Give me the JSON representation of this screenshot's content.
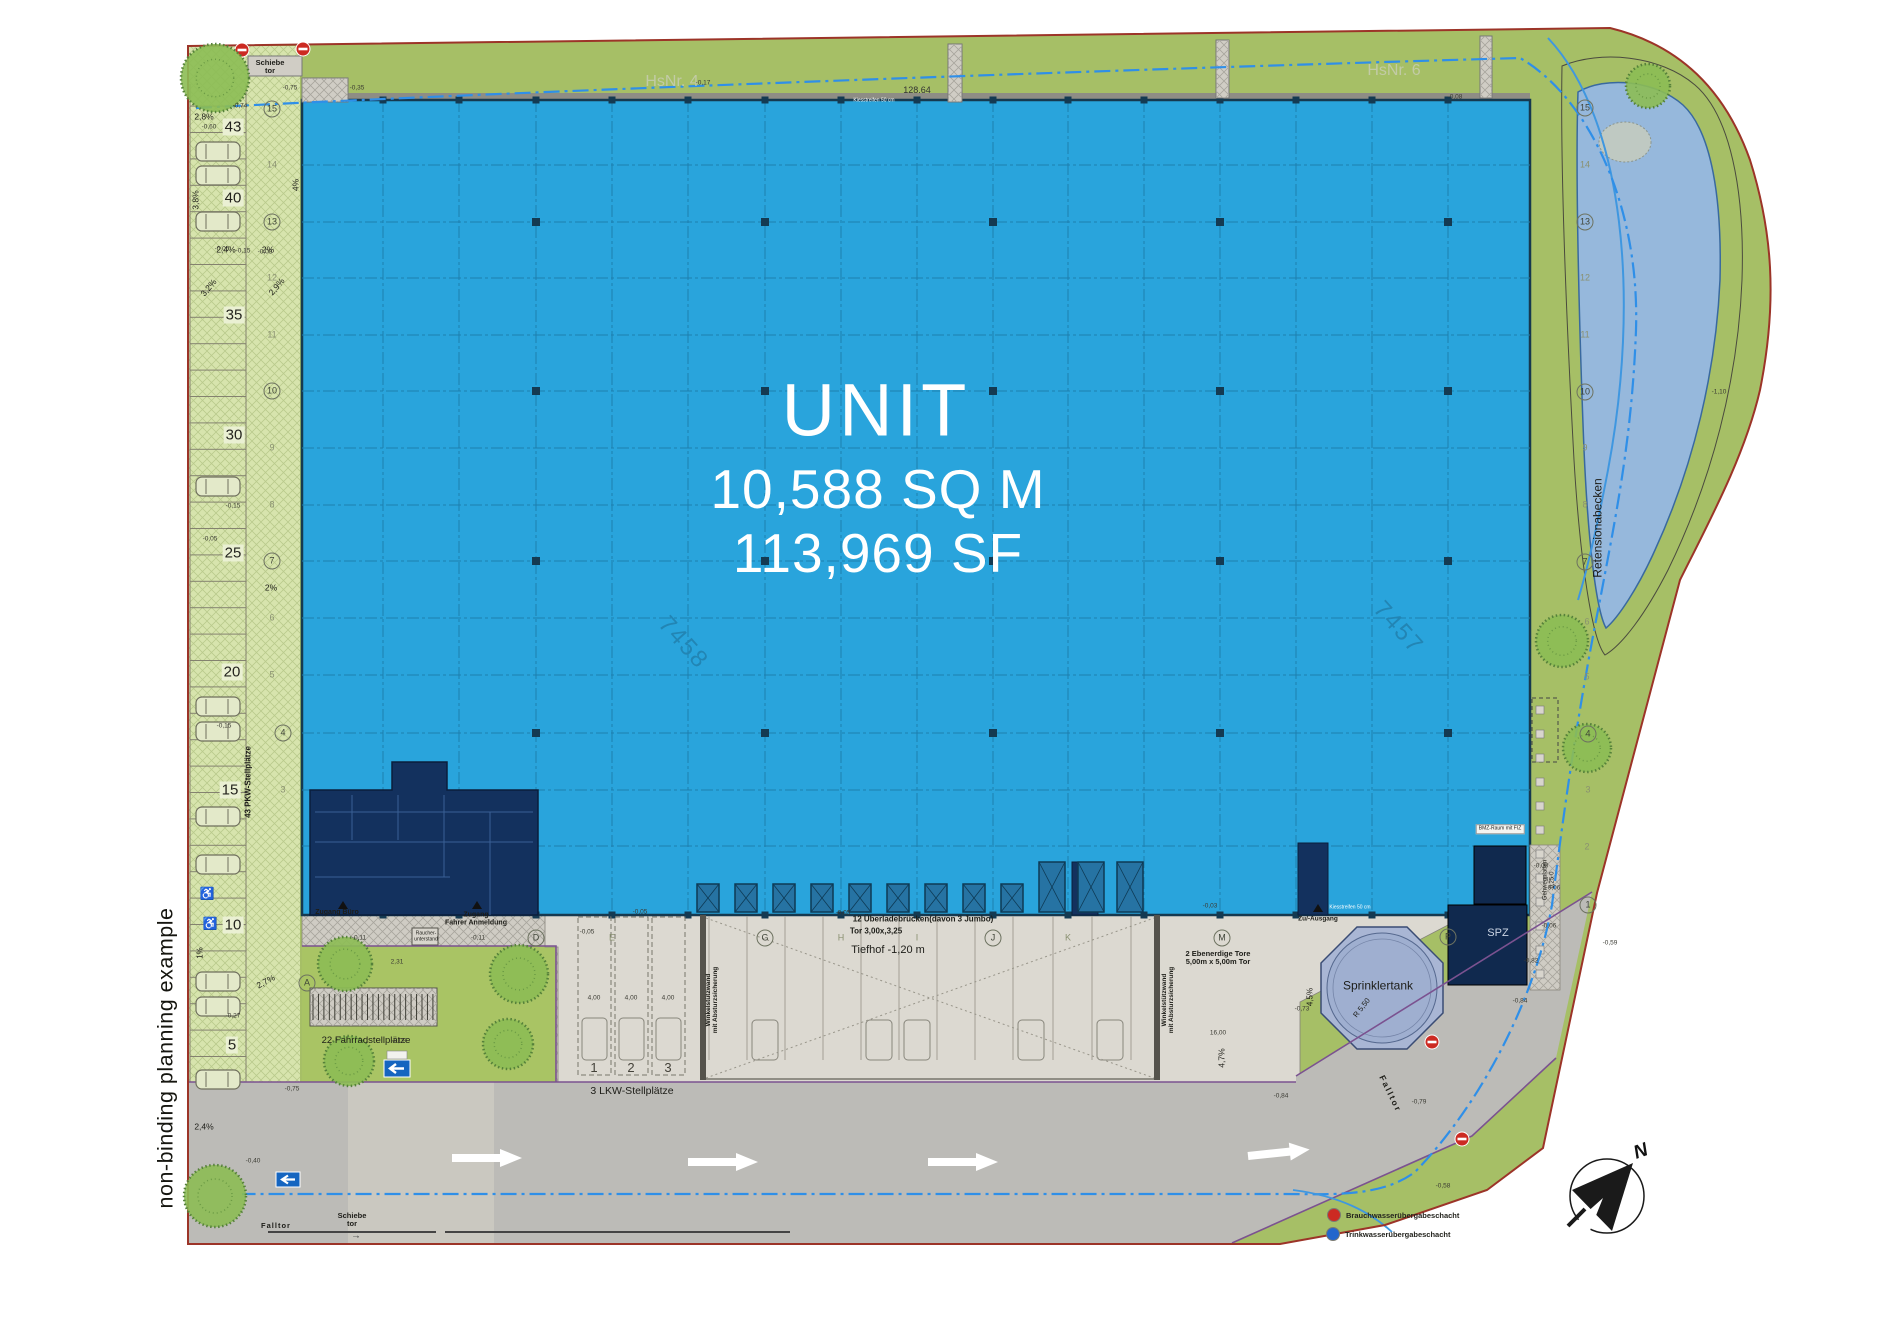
{
  "plan": {
    "unit_label": "UNIT",
    "area_sqm": "10,588 SQ M",
    "area_sf": "113,969 SF"
  },
  "note": "non-binding planning example",
  "compass": {
    "north_label": "N"
  },
  "legend": {
    "items": [
      {
        "label": "Brauchwasserübergabeschacht",
        "color": "#cc2a22"
      },
      {
        "label": "Trinkwasserübergabeschacht",
        "color": "#2266cc"
      }
    ]
  },
  "colors": {
    "hall_blue": "#29a4dc",
    "dark_navy": "#13315e",
    "dock_blue": "#2673a3",
    "parking_green": "#d7e4ad",
    "landscape_green": "#a6bf66",
    "lawn_green": "#a9c464",
    "basin_blue": "#96b8dc",
    "sprinkler_blue": "#a9b6d4",
    "road_gray": "#bcbbb7",
    "apron_gray": "#dcd9d1",
    "boundary_red": "#9c3428",
    "utility_blue_dash": "#2f8fe8",
    "edge_purple": "#7b5290"
  },
  "labels": [
    {
      "n": "hsnr-4-label",
      "t": "HsNr. 4",
      "x": 672,
      "y": 82,
      "s": 16,
      "c": "#c2cba6"
    },
    {
      "n": "hsnr-6-label",
      "t": "HsNr. 6",
      "x": 1394,
      "y": 71,
      "s": 16,
      "c": "#c2cba6"
    },
    {
      "n": "schiebetor-top-label",
      "t": "Schiebe\ntor",
      "x": 270,
      "y": 67,
      "s": 7.5,
      "w": 700
    },
    {
      "n": "schiebetor-bottom-label",
      "t": "Schiebe\ntor",
      "x": 352,
      "y": 1220,
      "s": 7.5,
      "w": 700
    },
    {
      "n": "schiebetor-arrow",
      "t": "→",
      "x": 356,
      "y": 1236,
      "s": 10,
      "c": "#444"
    },
    {
      "n": "falltor-sw-label",
      "t": "Falltor",
      "x": 276,
      "y": 1226,
      "s": 7.5,
      "w": 700,
      "ls": 1
    },
    {
      "n": "falltor-east-label",
      "t": "Falltor",
      "x": 1390,
      "y": 1094,
      "r": 64,
      "s": 8.5,
      "w": 700,
      "ls": 2
    },
    {
      "n": "zugang-buero-label",
      "t": "Zugang Büro",
      "x": 337,
      "y": 913,
      "s": 7,
      "w": 700
    },
    {
      "n": "zugang-fahrer-label",
      "t": "Zugang\nFahrer Anmeldung",
      "x": 476,
      "y": 919,
      "s": 7,
      "w": 700
    },
    {
      "n": "raucherunterstand-label",
      "t": "Raucher-\nunterstand",
      "x": 426,
      "y": 937,
      "s": 5
    },
    {
      "n": "fahrradstellplaetze-label",
      "t": "22 Fahrradstellplätze",
      "x": 366,
      "y": 1041,
      "s": 9.5
    },
    {
      "n": "lkw-stellplaetze-label",
      "t": "3 LKW-Stellplätze",
      "x": 632,
      "y": 1092,
      "s": 10.5
    },
    {
      "n": "lkw-stall-1",
      "t": "1",
      "x": 594,
      "y": 1068,
      "s": 13,
      "c": "#44423a"
    },
    {
      "n": "lkw-stall-2",
      "t": "2",
      "x": 631,
      "y": 1068,
      "s": 13,
      "c": "#44423a"
    },
    {
      "n": "lkw-stall-3",
      "t": "3",
      "x": 668,
      "y": 1068,
      "s": 13,
      "c": "#44423a"
    },
    {
      "n": "ueberladebruecken-label",
      "t": "12 Überladebrücken(davon 3 Jumbo)",
      "x": 923,
      "y": 920,
      "s": 8,
      "w": 700
    },
    {
      "n": "tor-label",
      "t": "Tor 3,00x,3,25",
      "x": 876,
      "y": 932,
      "s": 8,
      "w": 700
    },
    {
      "n": "tiefhof-label",
      "t": "Tiefhof -1,20 m",
      "x": 888,
      "y": 950,
      "s": 11
    },
    {
      "n": "ebenerdige-tore-label",
      "t": "2 Ebenerdige Tore\n5,00m x 5,00m Tor",
      "x": 1218,
      "y": 958,
      "s": 7.5,
      "w": 700
    },
    {
      "n": "winkelstuetzwand-west-label",
      "t": "Winkelstützwand\nmit Absturzsicherung",
      "x": 712,
      "y": 1000,
      "r": -90,
      "s": 6.5,
      "w": 700
    },
    {
      "n": "winkelstuetzwand-ost-label",
      "t": "Winkelstützwand\nmit Absturzsicherung",
      "x": 1168,
      "y": 1000,
      "r": -90,
      "s": 6.5,
      "w": 700
    },
    {
      "n": "pkw-stellplaetze-label",
      "t": "43 PKW-Stellplätze",
      "x": 249,
      "y": 782,
      "r": -90,
      "s": 8,
      "w": 700
    },
    {
      "n": "gehwegplatten-label",
      "t": "Gehwegplatten\n0,25·0",
      "x": 1549,
      "y": 880,
      "r": -90,
      "s": 6
    },
    {
      "n": "retensionabecken-label",
      "t": "Retensionabecken",
      "x": 1598,
      "y": 528,
      "r": -90,
      "s": 12
    },
    {
      "n": "sprinklertank-label",
      "t": "Sprinklertank",
      "x": 1378,
      "y": 986,
      "s": 12
    },
    {
      "n": "radius-550-label",
      "t": "R 5,50",
      "x": 1362,
      "y": 1008,
      "r": -52,
      "s": 7.5
    },
    {
      "n": "spz-label",
      "t": "SPZ",
      "x": 1498,
      "y": 933,
      "s": 11,
      "c": "#ccd5e4"
    },
    {
      "n": "bmz-raum-label",
      "t": "BMZ-Raum mit FIZ",
      "x": 1500,
      "y": 829,
      "s": 5,
      "bg": "#f4f4f0",
      "c": "#222"
    },
    {
      "n": "zu-ausgang-label",
      "t": "Zu/-Ausgang",
      "x": 1318,
      "y": 919,
      "s": 6.5,
      "w": 700
    },
    {
      "n": "parcel-7458",
      "t": "7458",
      "x": 683,
      "y": 643,
      "r": 48,
      "s": 24,
      "c": "#2285b4",
      "ls": 2
    },
    {
      "n": "parcel-7457",
      "t": "7457",
      "x": 1398,
      "y": 628,
      "r": 48,
      "s": 24,
      "c": "#2285b4",
      "ls": 2
    },
    {
      "n": "dim-128-64",
      "t": "128.64",
      "x": 917,
      "y": 91,
      "s": 9,
      "c": "#333"
    },
    {
      "n": "kiesstreifen-top-label",
      "t": "Kiesstreifen 50 cm",
      "x": 874,
      "y": 101,
      "s": 5,
      "c": "#fff"
    },
    {
      "n": "kiesstreifen-sued-label",
      "t": "Kiesstreifen 50 cm",
      "x": 1350,
      "y": 908,
      "s": 5,
      "c": "#fff"
    },
    {
      "n": "slope-label",
      "t": "2,8%",
      "x": 204,
      "y": 117,
      "s": 8.5
    },
    {
      "n": "slope-label",
      "t": "3,8%",
      "x": 196,
      "y": 200,
      "r": -90,
      "s": 8.5
    },
    {
      "n": "slope-label",
      "t": "2,4%",
      "x": 226,
      "y": 250,
      "s": 8.5
    },
    {
      "n": "slope-label",
      "t": "2%",
      "x": 268,
      "y": 250,
      "s": 8.5
    },
    {
      "n": "slope-label",
      "t": "4%",
      "x": 296,
      "y": 185,
      "r": -90,
      "s": 8.5
    },
    {
      "n": "slope-label",
      "t": "3,2%",
      "x": 209,
      "y": 288,
      "r": -50,
      "s": 8.5
    },
    {
      "n": "slope-label",
      "t": "2,9%",
      "x": 277,
      "y": 287,
      "r": -50,
      "s": 8.5
    },
    {
      "n": "slope-label",
      "t": "2%",
      "x": 271,
      "y": 588,
      "s": 8.5
    },
    {
      "n": "slope-label",
      "t": "2,7%",
      "x": 266,
      "y": 982,
      "r": -28,
      "s": 8.5
    },
    {
      "n": "slope-label",
      "t": "1%",
      "x": 201,
      "y": 953,
      "r": -90,
      "s": 8
    },
    {
      "n": "slope-label",
      "t": "2,4%",
      "x": 204,
      "y": 1127,
      "s": 8.5
    },
    {
      "n": "slope-label",
      "t": "4,5%",
      "x": 1311,
      "y": 997,
      "r": -90,
      "s": 8
    },
    {
      "n": "slope-label",
      "t": "4,7%",
      "x": 1222,
      "y": 1058,
      "r": -90,
      "s": 8.5
    },
    {
      "n": "accessible-parking-icon",
      "t": "♿",
      "x": 207,
      "y": 894,
      "s": 12,
      "c": "#555"
    },
    {
      "n": "accessible-parking-icon",
      "t": "♿",
      "x": 210,
      "y": 924,
      "s": 12,
      "c": "#555"
    }
  ],
  "stall_numbers": [
    {
      "v": "43",
      "x": 233,
      "y": 127
    },
    {
      "v": "40",
      "x": 233,
      "y": 198
    },
    {
      "v": "35",
      "x": 234,
      "y": 315
    },
    {
      "v": "30",
      "x": 234,
      "y": 435
    },
    {
      "v": "25",
      "x": 233,
      "y": 553
    },
    {
      "v": "20",
      "x": 232,
      "y": 672
    },
    {
      "v": "15",
      "x": 230,
      "y": 790
    },
    {
      "v": "10",
      "x": 233,
      "y": 925
    },
    {
      "v": "5",
      "x": 232,
      "y": 1045
    }
  ],
  "grid": {
    "cols": [
      {
        "l": "A",
        "x": 307,
        "y": 983,
        "c": true
      },
      {
        "l": "D",
        "x": 536,
        "y": 938,
        "c": true
      },
      {
        "l": "E",
        "x": 612,
        "y": 938,
        "c": false
      },
      {
        "l": "G",
        "x": 765,
        "y": 938,
        "c": true
      },
      {
        "l": "H",
        "x": 841,
        "y": 938,
        "c": false
      },
      {
        "l": "I",
        "x": 917,
        "y": 938,
        "c": false
      },
      {
        "l": "J",
        "x": 993,
        "y": 938,
        "c": true
      },
      {
        "l": "K",
        "x": 1068,
        "y": 938,
        "c": false
      },
      {
        "l": "M",
        "x": 1222,
        "y": 938,
        "c": true
      },
      {
        "l": "P",
        "x": 1448,
        "y": 937,
        "c": true
      }
    ],
    "rows_left": [
      {
        "l": "15",
        "x": 272,
        "y": 109,
        "c": true
      },
      {
        "l": "14",
        "x": 272,
        "y": 165,
        "c": false
      },
      {
        "l": "13",
        "x": 272,
        "y": 222,
        "c": true
      },
      {
        "l": "12",
        "x": 272,
        "y": 278,
        "c": false
      },
      {
        "l": "11",
        "x": 272,
        "y": 335,
        "c": false
      },
      {
        "l": "10",
        "x": 272,
        "y": 391,
        "c": true
      },
      {
        "l": "9",
        "x": 272,
        "y": 448,
        "c": false
      },
      {
        "l": "8",
        "x": 272,
        "y": 505,
        "c": false
      },
      {
        "l": "7",
        "x": 272,
        "y": 561,
        "c": true
      },
      {
        "l": "6",
        "x": 272,
        "y": 618,
        "c": false
      },
      {
        "l": "5",
        "x": 272,
        "y": 675,
        "c": false
      },
      {
        "l": "4",
        "x": 283,
        "y": 733,
        "c": true
      },
      {
        "l": "3",
        "x": 283,
        "y": 790,
        "c": false
      }
    ],
    "rows_right": [
      {
        "l": "15",
        "x": 1585,
        "y": 108,
        "c": true
      },
      {
        "l": "14",
        "x": 1585,
        "y": 165,
        "c": false
      },
      {
        "l": "13",
        "x": 1585,
        "y": 222,
        "c": true
      },
      {
        "l": "12",
        "x": 1585,
        "y": 278,
        "c": false
      },
      {
        "l": "11",
        "x": 1585,
        "y": 335,
        "c": false
      },
      {
        "l": "10",
        "x": 1585,
        "y": 392,
        "c": true
      },
      {
        "l": "9",
        "x": 1585,
        "y": 448,
        "c": false
      },
      {
        "l": "8",
        "x": 1585,
        "y": 505,
        "c": false
      },
      {
        "l": "7",
        "x": 1585,
        "y": 562,
        "c": true
      },
      {
        "l": "6",
        "x": 1587,
        "y": 622,
        "c": false
      },
      {
        "l": "5",
        "x": 1587,
        "y": 677,
        "c": false
      },
      {
        "l": "4",
        "x": 1588,
        "y": 734,
        "c": true
      },
      {
        "l": "3",
        "x": 1588,
        "y": 790,
        "c": false
      },
      {
        "l": "2",
        "x": 1587,
        "y": 847,
        "c": false
      },
      {
        "l": "1",
        "x": 1588,
        "y": 905,
        "c": true
      }
    ]
  },
  "spot_values": [
    {
      "x": 290,
      "y": 88,
      "t": "-0,75"
    },
    {
      "x": 357,
      "y": 88,
      "t": "-0,35"
    },
    {
      "x": 703,
      "y": 83,
      "t": "-0,17"
    },
    {
      "x": 1455,
      "y": 97,
      "t": "-0,08"
    },
    {
      "x": 240,
      "y": 106,
      "t": "-0,74"
    },
    {
      "x": 209,
      "y": 127,
      "t": "-0,60"
    },
    {
      "x": 222,
      "y": 249,
      "t": "-0,05"
    },
    {
      "x": 243,
      "y": 251,
      "t": "-0,15"
    },
    {
      "x": 265,
      "y": 252,
      "t": "-0,03"
    },
    {
      "x": 233,
      "y": 506,
      "t": "-0,15"
    },
    {
      "x": 210,
      "y": 539,
      "t": "-0,05"
    },
    {
      "x": 224,
      "y": 726,
      "t": "-0,15"
    },
    {
      "x": 233,
      "y": 1016,
      "t": "-0,27"
    },
    {
      "x": 253,
      "y": 1161,
      "t": "-0,40"
    },
    {
      "x": 292,
      "y": 1089,
      "t": "-0,75"
    },
    {
      "x": 359,
      "y": 938,
      "t": "-0,11"
    },
    {
      "x": 478,
      "y": 938,
      "t": "-0,11"
    },
    {
      "x": 587,
      "y": 932,
      "t": "-0,05"
    },
    {
      "x": 640,
      "y": 912,
      "t": "-0,05"
    },
    {
      "x": 843,
      "y": 913,
      "t": "-0,05"
    },
    {
      "x": 397,
      "y": 962,
      "t": "2,31"
    },
    {
      "x": 399,
      "y": 1041,
      "t": "-0,09"
    },
    {
      "x": 1210,
      "y": 906,
      "t": "-0,03"
    },
    {
      "x": 1541,
      "y": 866,
      "t": "-0,08"
    },
    {
      "x": 1553,
      "y": 888,
      "t": "-0,06"
    },
    {
      "x": 1549,
      "y": 926,
      "t": "-0,06"
    },
    {
      "x": 1520,
      "y": 1001,
      "t": "-0,84"
    },
    {
      "x": 1419,
      "y": 1102,
      "t": "-0,79"
    },
    {
      "x": 1281,
      "y": 1096,
      "t": "-0,84"
    },
    {
      "x": 1443,
      "y": 1186,
      "t": "-0,58"
    },
    {
      "x": 1302,
      "y": 1009,
      "t": "-0,73"
    },
    {
      "x": 1719,
      "y": 392,
      "t": "-1,10"
    },
    {
      "x": 1610,
      "y": 943,
      "t": "-0,59"
    },
    {
      "x": 1531,
      "y": 961,
      "t": "-0,82"
    },
    {
      "x": 594,
      "y": 998,
      "t": "4,00"
    },
    {
      "x": 631,
      "y": 998,
      "t": "4,00"
    },
    {
      "x": 668,
      "y": 998,
      "t": "4,00"
    },
    {
      "x": 1218,
      "y": 1033,
      "t": "16,00"
    }
  ]
}
